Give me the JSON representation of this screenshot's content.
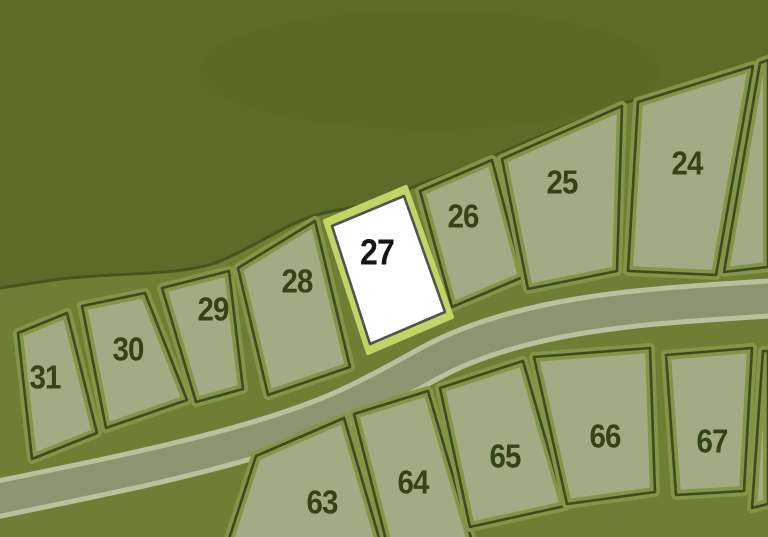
{
  "map": {
    "title": "Subdivision lot plat map",
    "highlighted_lot": "27",
    "colors": {
      "terrain_hill": "#5b6c29",
      "terrain_ground": "#6e7e34",
      "hill_edge": "#46541f",
      "lot_fill": "#a3ab85",
      "lot_verge": "#839547",
      "lot_outline": "#3e4a21",
      "road_surface": "#8a9670",
      "road_edge": "#b9c09e",
      "lot_number": "#344415",
      "highlight_fill": "#ffffff",
      "highlight_verge": "#c2d466",
      "highlight_outline": "#4e5450",
      "highlight_number": "#141414"
    },
    "lots": [
      {
        "number": "24",
        "row": "upper",
        "highlighted": false
      },
      {
        "number": "25",
        "row": "upper",
        "highlighted": false
      },
      {
        "number": "26",
        "row": "upper",
        "highlighted": false
      },
      {
        "number": "27",
        "row": "upper",
        "highlighted": true
      },
      {
        "number": "28",
        "row": "upper",
        "highlighted": false
      },
      {
        "number": "29",
        "row": "upper",
        "highlighted": false
      },
      {
        "number": "30",
        "row": "upper",
        "highlighted": false
      },
      {
        "number": "31",
        "row": "upper",
        "highlighted": false
      },
      {
        "number": "63",
        "row": "lower",
        "highlighted": false
      },
      {
        "number": "64",
        "row": "lower",
        "highlighted": false
      },
      {
        "number": "65",
        "row": "lower",
        "highlighted": false
      },
      {
        "number": "66",
        "row": "lower",
        "highlighted": false
      },
      {
        "number": "67",
        "row": "lower",
        "highlighted": false
      }
    ]
  }
}
